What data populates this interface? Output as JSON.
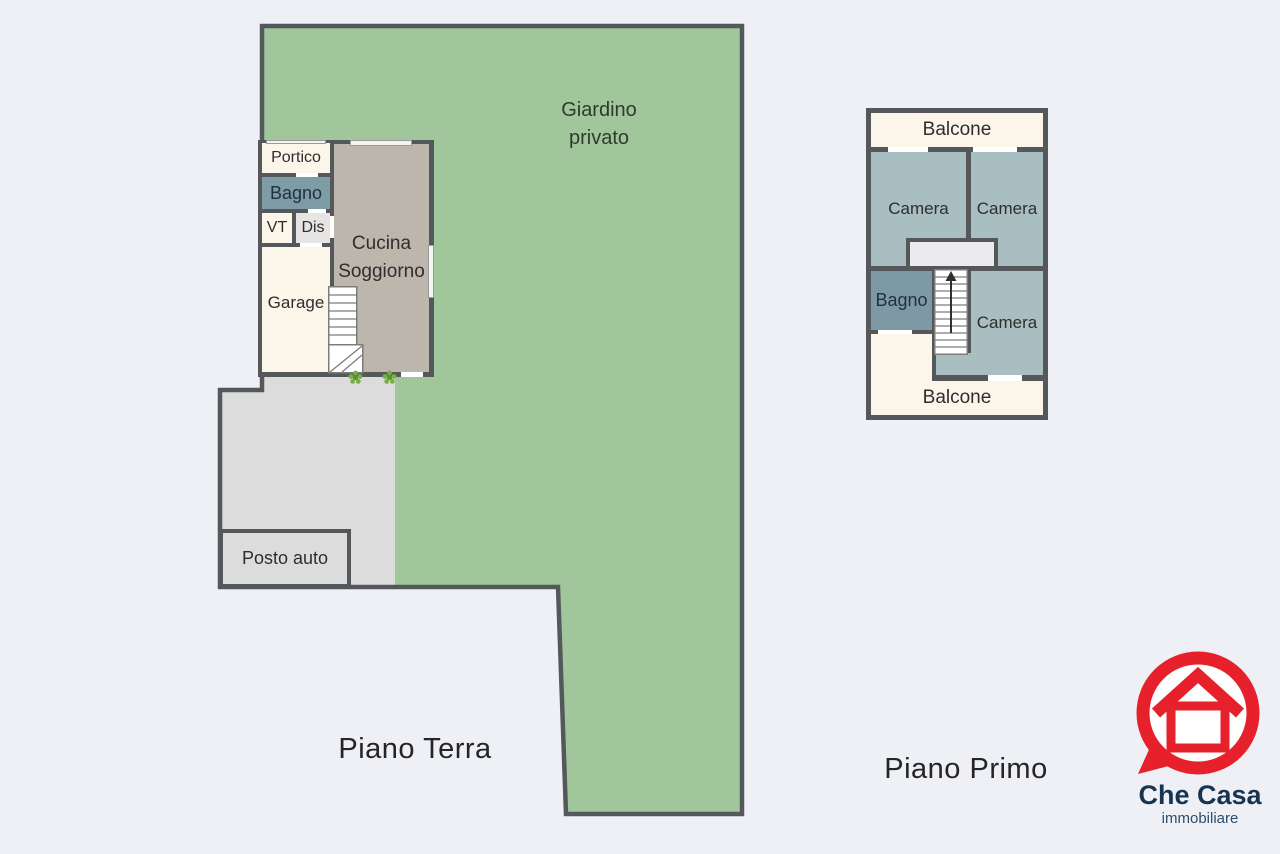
{
  "ground_floor": {
    "floor_label": "Piano Terra",
    "garden_label_line1": "Giardino",
    "garden_label_line2": "privato",
    "rooms": {
      "portico": "Portico",
      "bagno": "Bagno",
      "vt": "VT",
      "dis": "Dis",
      "garage": "Garage",
      "living_line1": "Cucina",
      "living_line2": "Soggiorno",
      "parking": "Posto auto"
    }
  },
  "first_floor": {
    "floor_label": "Piano Primo",
    "rooms": {
      "balcony_top": "Balcone",
      "bedroom_top_left": "Camera",
      "bedroom_top_right": "Camera",
      "bathroom": "Bagno",
      "bedroom_bottom": "Camera",
      "balcony_bottom": "Balcone"
    }
  },
  "logo": {
    "brand": "Che Casa",
    "tagline": "immobiliare"
  },
  "colors": {
    "background": "#eef0f6",
    "garden_green": "#a2c69c",
    "wall_dark": "#54585b",
    "room_cream": "#fbf5ea",
    "bathroom_teal": "#7d9ca6",
    "bedroom_teal": "#a8bec1",
    "living_gray": "#bcb6ad",
    "paving_gray": "#dcdcdd",
    "hall_gray": "#e6e5e4",
    "landing_gray": "#ebebee",
    "plant_green": "#76b043",
    "logo_red": "#e6212b",
    "logo_navy": "#173450"
  }
}
